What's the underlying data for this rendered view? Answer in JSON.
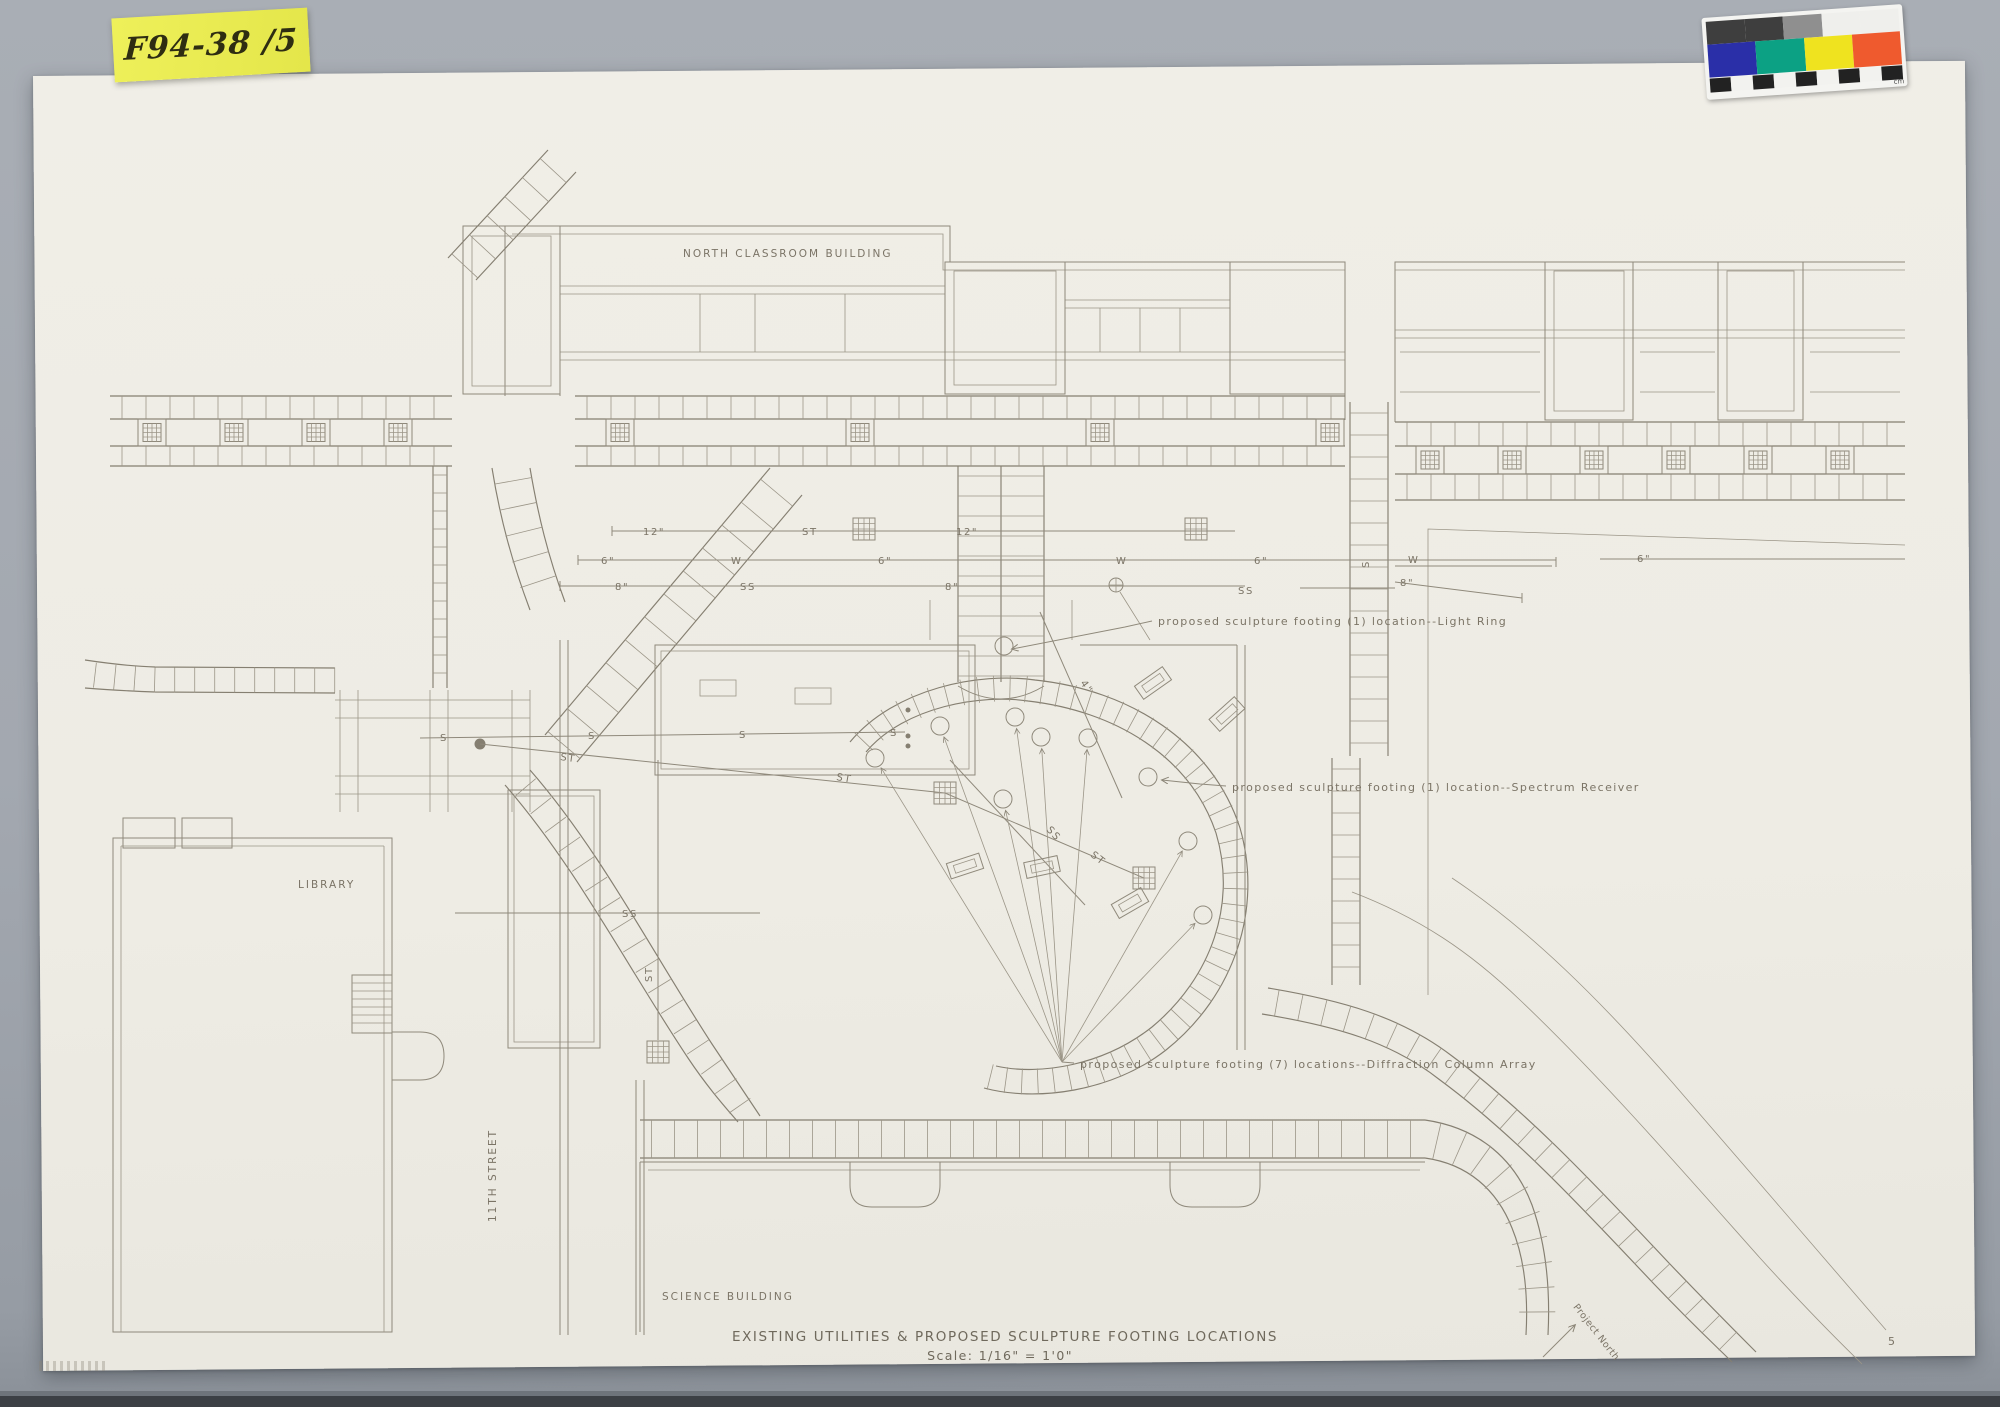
{
  "photo": {
    "catalog_note": "F94-38 /5",
    "scale_card_label": "cm"
  },
  "color_card": {
    "gray_row": [
      "#3e3e3e",
      "#8f8f8f",
      "#efefec"
    ],
    "color_row": [
      "#2a2fa8",
      "#0ca184",
      "#efe31f",
      "#ef5a2e"
    ],
    "checker": [
      "#222222",
      "#f2f2ef"
    ]
  },
  "plan": {
    "buildings": {
      "north_classroom": "NORTH CLASSROOM BUILDING",
      "library": "LIBRARY",
      "science": "SCIENCE BUILDING",
      "street": "11TH STREET"
    },
    "annotations": {
      "light_ring": "proposed sculpture footing (1) location--Light Ring",
      "spectrum_receiver": "proposed sculpture footing (1) location--Spectrum Receiver",
      "diffraction": "proposed sculpture footing (7) locations--Diffraction Column Array"
    },
    "utilities": {
      "st": "ST",
      "w": "W",
      "ss": "SS",
      "s": "S",
      "d12": "12\"",
      "d8": "8\"",
      "d6": "6\"",
      "d4": "4\""
    },
    "titleblock": {
      "title": "EXISTING UTILITIES & PROPOSED SCULPTURE FOOTING LOCATIONS",
      "scale": "Scale:  1/16\" = 1'0\"",
      "north": "Project North",
      "sheet": "5"
    }
  }
}
